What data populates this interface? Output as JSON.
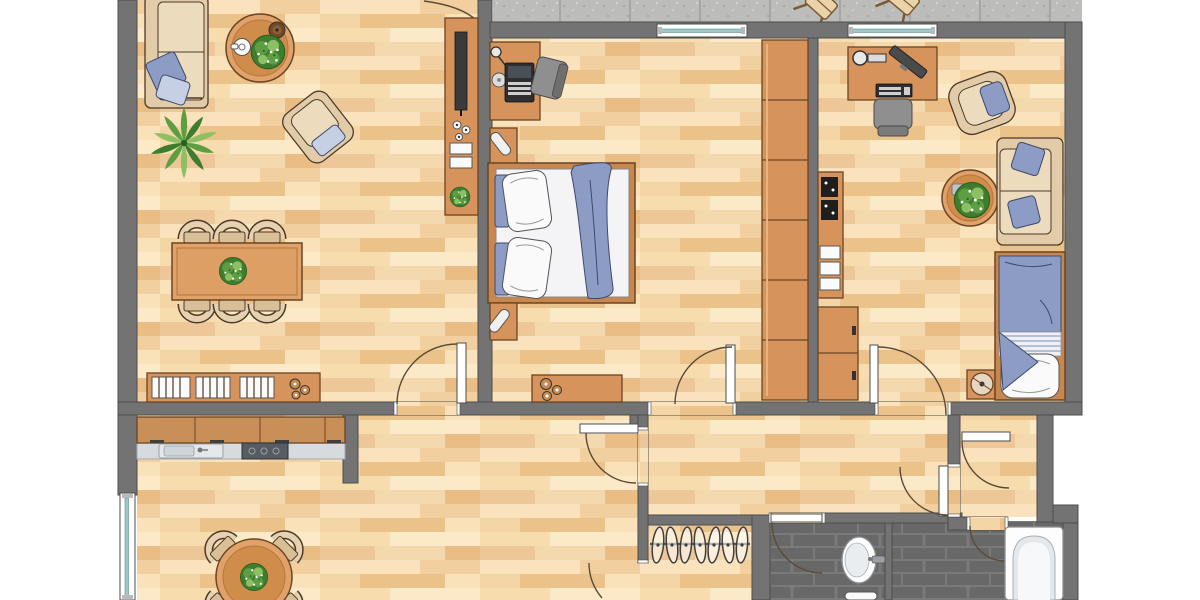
{
  "title": "Apartment floor plan",
  "canvas": {
    "width": 1200,
    "height": 600
  },
  "palette": {
    "wall": "#737373",
    "wallLine": "#4c4c4c",
    "floorBase": "#f6dcb3",
    "wood": "#d6945c",
    "woodLight": "#e0a269",
    "woodLine": "#6b4423",
    "beige": "#e2cba8",
    "beigeLine": "#4d3a28",
    "blue": "#8c9cc4",
    "tile": "#686868",
    "tileLine": "#7a7a7a",
    "balcony": "#bcbcba",
    "glass": "#9fc6c9",
    "plant": "#5d9e43",
    "plantDark": "#3f7d2e",
    "plantLight": "#8cc063",
    "arc": "#5b4a36"
  },
  "rooms": [
    {
      "id": "living-room",
      "label": "Living room",
      "furniture": [
        "sofa with blue pillows",
        "round coffee table with teapot, bowl and plant",
        "armchair",
        "floor plant",
        "dining table with plant centerpiece",
        "6 dining chairs",
        "TV sideboard with shelves and plant",
        "low bookshelf sideboard"
      ]
    },
    {
      "id": "bedroom",
      "label": "Bedroom",
      "furniture": [
        "desk with laptop, lamp and disc",
        "desk chair",
        "nightstand with lamp (top)",
        "double bed with two pillow sets and blue blanket",
        "nightstand with lamp (bottom)",
        "sideboard with knobs",
        "6-section wardrobe"
      ]
    },
    {
      "id": "kids-room",
      "label": "Kids / office room",
      "furniture": [
        "desk with lamp, monitor and keyboard",
        "office chair",
        "armchair with blue cushion",
        "round side table with plant",
        "sofa with two blue pillows",
        "shelf unit with game pads and shelves",
        "two-door dresser",
        "drum stool",
        "single bed with blue blanket and pillow"
      ]
    },
    {
      "id": "kitchen",
      "label": "Kitchen",
      "furniture": [
        "cabinet row",
        "counter with sink",
        "stove",
        "round table with plant",
        "4 chairs"
      ]
    },
    {
      "id": "hallway",
      "label": "Hallway",
      "furniture": [
        "coat rack with 7 hangers"
      ]
    },
    {
      "id": "vestibule",
      "label": "Vestibule",
      "furniture": []
    },
    {
      "id": "wc",
      "label": "WC",
      "furniture": [
        "washbasin",
        "toilet"
      ]
    },
    {
      "id": "bathroom",
      "label": "Bathroom",
      "furniture": [
        "bathtub"
      ]
    },
    {
      "id": "balcony",
      "label": "Balcony",
      "furniture": [
        "2 folding chairs"
      ]
    }
  ],
  "windows": [
    "kitchen-left-wall",
    "bedroom-top-wall",
    "kids-room-top-wall"
  ],
  "doors": [
    "balcony-living-room",
    "living-room-hall",
    "bedroom-hall",
    "kids-room-hall",
    "hall-inner",
    "hall-bottom",
    "wc",
    "vestibule-left",
    "vestibule-top",
    "vestibule-bathroom"
  ]
}
